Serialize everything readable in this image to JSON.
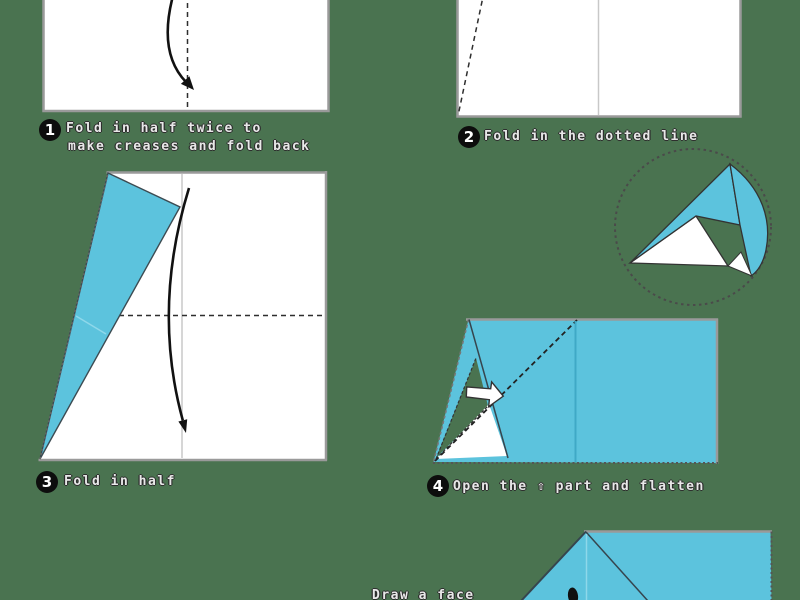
{
  "colors": {
    "background": "#4a7350",
    "paper_blue": "#5cc3dd",
    "paper_white": "#ffffff",
    "border_gray": "#9a9a9a",
    "line_dark": "#2e2e2e",
    "crease_light_blue": "#8ed8ea",
    "crease_teal": "#3fa9c6"
  },
  "steps": [
    {
      "number": "1",
      "label": "Fold in half twice to",
      "label2": "make creases and fold back"
    },
    {
      "number": "2",
      "label": "Fold in the dotted line"
    },
    {
      "number": "3",
      "label": "Fold in half"
    },
    {
      "number": "4",
      "label": "Open the ⇧ part and flatten"
    }
  ],
  "caption": {
    "draw_face": "Draw a face"
  }
}
